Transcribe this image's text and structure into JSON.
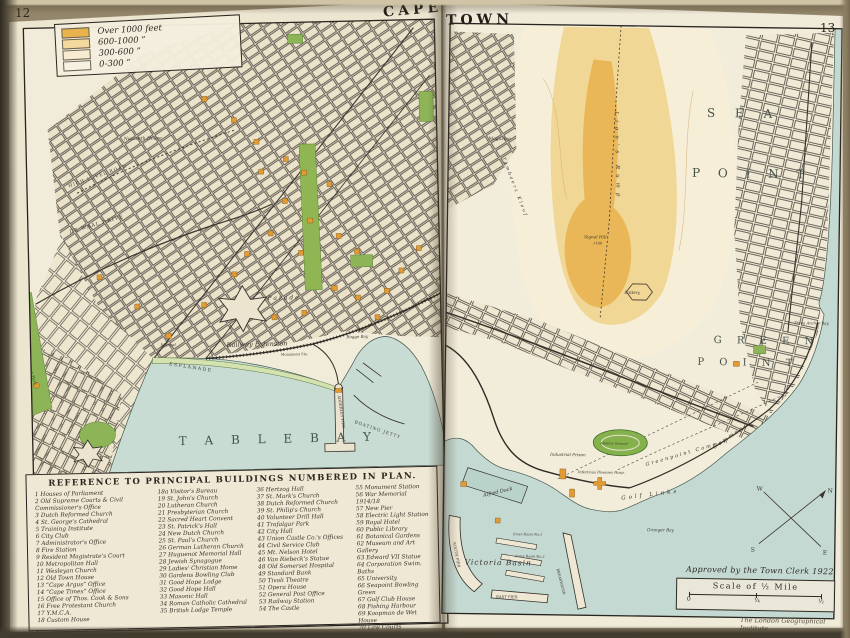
{
  "folios": {
    "left": "12",
    "right": "13"
  },
  "title": {
    "left": "CAPE",
    "right": "TOWN"
  },
  "legend": {
    "items": [
      {
        "label": "Over 1000 feet",
        "color": "#e8b34c"
      },
      {
        "label": "600-1000  ”",
        "color": "#f3d99d"
      },
      {
        "label": "300-600  ”",
        "color": "#f7ecd2"
      },
      {
        "label": "0-300  ”",
        "color": "#f6f1e1"
      }
    ]
  },
  "labels": {
    "table_bay": "T A B L E   B A Y",
    "esplanade": "ESPLANADE",
    "railway_extension": "Railway Extension",
    "market": "Market",
    "parade": "Parade",
    "rogge_bay": "Rogge Bay",
    "boating_jetty": "BOATING JETTY",
    "adderley_pier": "ADDERLEY PIER",
    "monument_station": "Monument Sta.",
    "nazareth_house": "Nazareth House",
    "high_level_road": "HIGH LEVEL ROAD",
    "de_waal_drive": "DE WAAL DRIVE",
    "trafalgar_park": "Trafalgar Park",
    "sea": "S E A",
    "point": "P O I N T",
    "green": "G R E E N",
    "point2": "P O I N T",
    "common": "Common",
    "lions_rump": "Lion's  Rump",
    "signal_hill": "Signal Hill",
    "signal_elev": "1160",
    "magazine": "Magazine",
    "tamboers_kloof": "Tamboers Kloof",
    "three_anchor_bay": "Three Anchor Bay",
    "battery": "Battery",
    "greenpoint_common": "Greenpoint  Common",
    "golf_links": "Golf  Links",
    "granger_bay": "Granger Bay",
    "athletic_ground": "Athletic Ground",
    "industrial_prison": "Industrial Prison",
    "infectious_hosp": "Infectious Diseases Hosp.",
    "alfred_dock": "Alfred Dock",
    "victoria_basin": "Victoria Basin",
    "south_pier": "SOUTH PIER",
    "east_pier": "EAST PIER",
    "breakwater": "BREAKWATER",
    "inner_basin": "Inner Basin No.1",
    "outer_basin": "Outer Basin No.2"
  },
  "compass": {
    "n": "N",
    "s": "S",
    "e": "E",
    "w": "W"
  },
  "reference": {
    "title": "REFERENCE TO PRINCIPAL BUILDINGS NUMBERED IN PLAN.",
    "col1": [
      "1  Houses of Parliament",
      "2  Old Supreme Courts & Civil Commissioner's Office",
      "3  Dutch Reformed Church",
      "4  St. George's Cathedral",
      "5  Training Institute",
      "6  City Club",
      "7  Administrator's Office",
      "8  Fire Station",
      "9  Resident Magistrate's Court",
      "10  Metropolitan Hall",
      "11  Wesleyan Church",
      "12  Old Town House",
      "13  “Cape Argus” Office",
      "14  “Cape Times” Office",
      "15  Office of Thos. Cook & Sons",
      "16  Free Protestant Church",
      "17  Y.M.C.A.",
      "18  Custom House"
    ],
    "col2": [
      "18a Visitor's Bureau",
      "19  St. John's Church",
      "20  Lutheran Church",
      "21  Presbyterian Church",
      "22  Sacred Heart Convent",
      "23  St. Patrick's Hall",
      "24  New Dutch Church",
      "25  St. Paul's Church",
      "26  German Lutheran Church",
      "27  Huguenot Memorial Hall",
      "28  Jewish Synagogue",
      "29  Ladies' Christian Home",
      "30  Gardens Bowling Club",
      "31  Good Hope Lodge",
      "32  Good Hope Hall",
      "33  Masonic Hall",
      "34  Roman Catholic Cathedral",
      "35  British Lodge Temple"
    ],
    "col3": [
      "36  Hertzog Hall",
      "37  St. Mark's Church",
      "38  Dutch Reformed Church",
      "39  St. Philip's Church",
      "40  Volunteer Drill Hall",
      "41  Trafalgar Park",
      "42  City Hall",
      "43  Union Castle Co.'s Offices",
      "44  Civil Service Club",
      "45  Mt. Nelson Hotel",
      "46  Van Riebeck's Statue",
      "48  Old Somerset Hospital",
      "49  Standard Bank",
      "50  Tivoli Theatre",
      "51  Opera House",
      "52  General Post Office",
      "53  Railway Station",
      "54  The Castle"
    ],
    "col4": [
      "55  Monument Station",
      "56  War Memorial 1914/18",
      "57  New Pier",
      "58  Electric Light Station",
      "59  Royal Hotel",
      "60  Public Library",
      "61  Botanical Gardens",
      "62  Museum and Art Gallery",
      "63  Edward VII Statue",
      "64  Corporation Swim. Baths",
      "65  University",
      "66  Seapoint Bowling Green",
      "67  Golf Club House",
      "68  Fishing Harbour",
      "69  Koopman de Wet House",
      "70  Law Courts",
      "71  Technical Institute",
      "72  Magistrate's Court",
      "73  Van Riebeck's Statue"
    ]
  },
  "scale": {
    "approved": "Approved by the Town Clerk 1922",
    "title": "Scale of ½ Mile",
    "ticks": [
      "0",
      "¼",
      "½"
    ]
  },
  "imprints": {
    "publisher": "George Philip & Son, Ltd.",
    "institute": "The London Geographical Institute"
  }
}
